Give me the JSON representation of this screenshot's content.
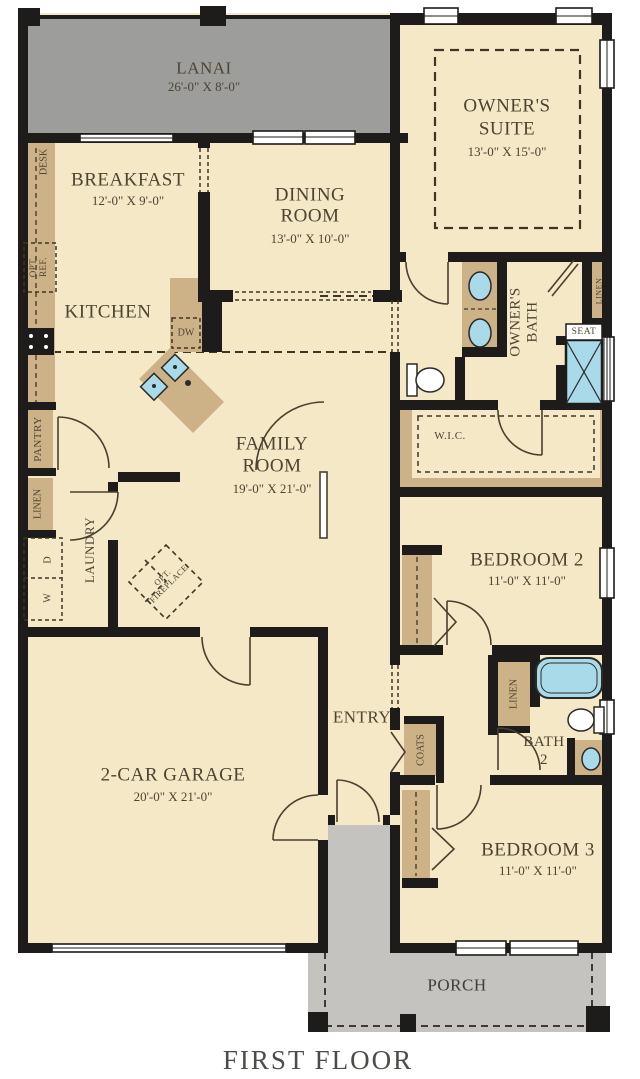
{
  "caption": "FIRST FLOOR",
  "colors": {
    "floor": "#f4e8c6",
    "lanai": "#9d9d9b",
    "porch": "#c4c3bf",
    "wall": "#1d1c1a",
    "counter": "#cdb287",
    "fixture_blue": "#a9dae9",
    "label_text": "#4d4433"
  },
  "rooms": {
    "lanai": {
      "name": "LANAI",
      "dims": "26'-0\" X 8'-0\""
    },
    "breakfast": {
      "name": "BREAKFAST",
      "dims": "12'-0\" X 9'-0\""
    },
    "dining": {
      "line1": "DINING",
      "line2": "ROOM",
      "dims": "13'-0\" X 10'-0\""
    },
    "owners_suite": {
      "line1": "OWNER'S",
      "line2": "SUITE",
      "dims": "13'-0\" X 15'-0\""
    },
    "kitchen": {
      "name": "KITCHEN"
    },
    "family": {
      "line1": "FAMILY",
      "line2": "ROOM",
      "dims": "19'-0\" X 21'-0\""
    },
    "owners_bath": {
      "line1": "OWNER'S",
      "line2": "BATH"
    },
    "wic": {
      "name": "W.I.C."
    },
    "bedroom2": {
      "name": "BEDROOM 2",
      "dims": "11'-0\" X 11'-0\""
    },
    "bath2": {
      "line1": "BATH",
      "line2": "2"
    },
    "entry": {
      "name": "ENTRY"
    },
    "garage": {
      "name": "2-CAR GARAGE",
      "dims": "20'-0\" X 21'-0\""
    },
    "bedroom3": {
      "name": "BEDROOM 3",
      "dims": "11'-0\" X 11'-0\""
    },
    "porch": {
      "name": "PORCH"
    }
  },
  "labels": {
    "desk": "DESK",
    "opt_ref_line1": "OPT.",
    "opt_ref_line2": "REF.",
    "dw": "DW",
    "pantry": "PANTRY",
    "linen_kitchen": "LINEN",
    "dryer": "D",
    "washer": "W",
    "laundry": "LAUNDRY",
    "fireplace_line1": "OPT.",
    "fireplace_line2": "FIREPLACE",
    "seat": "SEAT",
    "linen_owner": "LINEN",
    "linen_bath2": "LINEN",
    "coats": "COATS"
  }
}
